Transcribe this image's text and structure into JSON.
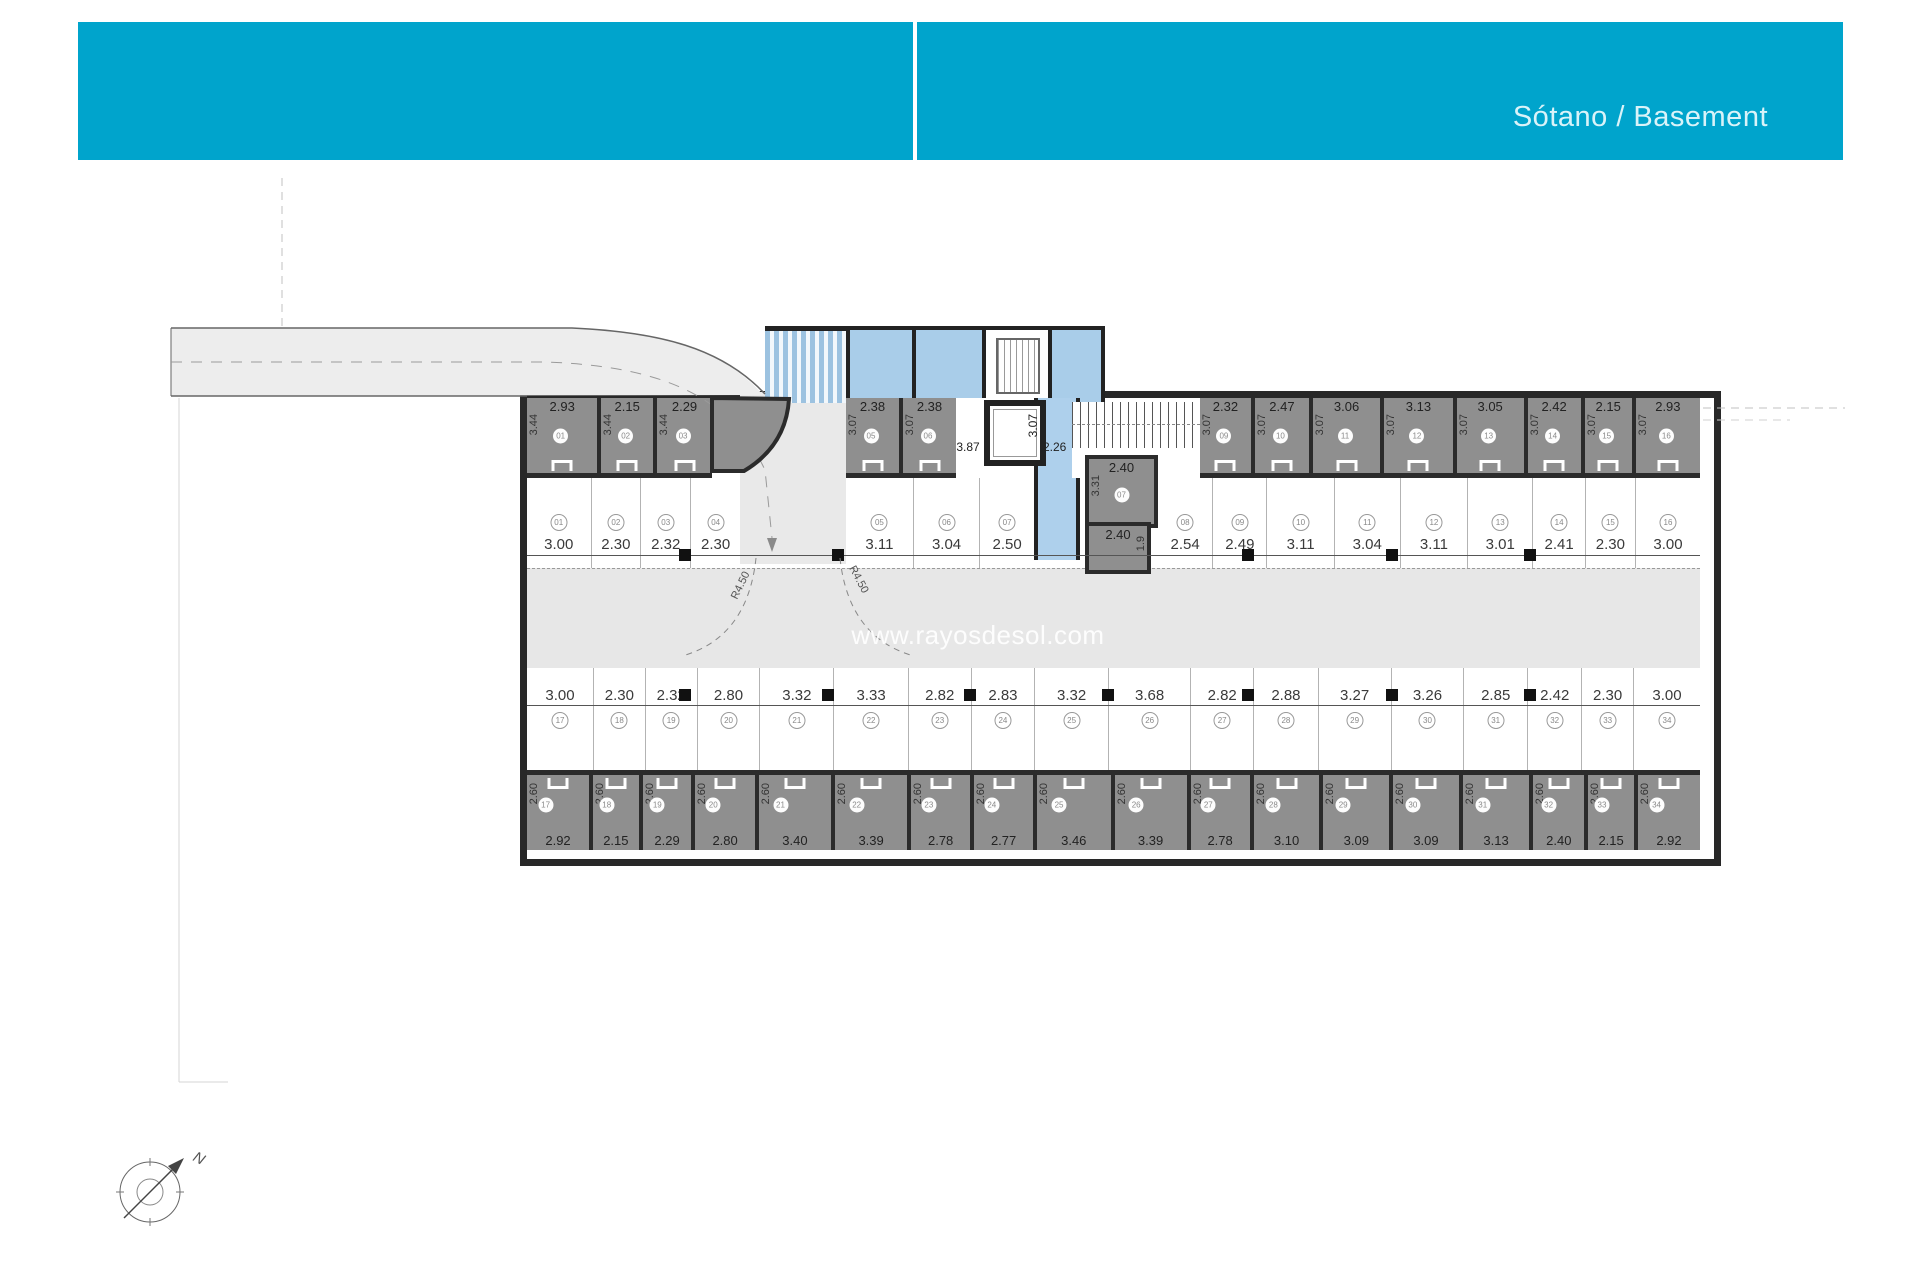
{
  "header": {
    "title": "Sótano / Basement",
    "accent_color": "#00a4cc"
  },
  "watermark": "www.rayosdesol.com",
  "compass_label": "N",
  "ramp_labels": {
    "r1": "R4.50",
    "r2": "R4.50"
  },
  "core": {
    "lobby_width": "3.87",
    "corridor_width": "2.26",
    "corridor_depth": "3.07",
    "box1": {
      "no": "07",
      "w": "2.40",
      "d": "3.31"
    },
    "box2": {
      "w": "2.40",
      "d": "1.9"
    }
  },
  "curved_unit": {
    "no": "04",
    "w": "2.80",
    "d": "3.44"
  },
  "rows": {
    "storage_top_left": {
      "units": [
        {
          "no": "01",
          "w": "2.93",
          "d": "3.44"
        },
        {
          "no": "02",
          "w": "2.15",
          "d": "3.44"
        },
        {
          "no": "03",
          "w": "2.29",
          "d": "3.44"
        }
      ]
    },
    "storage_top_mid": {
      "units": [
        {
          "no": "05",
          "w": "2.38",
          "d": "3.07"
        },
        {
          "no": "06",
          "w": "2.38",
          "d": "3.07"
        }
      ]
    },
    "storage_top_right": {
      "units": [
        {
          "no": "09",
          "w": "2.32",
          "d": "3.07"
        },
        {
          "no": "10",
          "w": "2.47",
          "d": "3.07"
        },
        {
          "no": "11",
          "w": "3.06",
          "d": "3.07"
        },
        {
          "no": "12",
          "w": "3.13",
          "d": "3.07"
        },
        {
          "no": "13",
          "w": "3.05",
          "d": "3.07"
        },
        {
          "no": "14",
          "w": "2.42",
          "d": "3.07"
        },
        {
          "no": "15",
          "w": "2.15",
          "d": "3.07"
        },
        {
          "no": "16",
          "w": "2.93",
          "d": "3.07"
        }
      ]
    },
    "parking_upper_left": {
      "units": [
        {
          "no": "01",
          "w": "3.00"
        },
        {
          "no": "02",
          "w": "2.30"
        },
        {
          "no": "03",
          "w": "2.32"
        },
        {
          "no": "04",
          "w": "2.30"
        }
      ]
    },
    "parking_upper_mid": {
      "units": [
        {
          "no": "05",
          "w": "3.11"
        },
        {
          "no": "06",
          "w": "3.04"
        },
        {
          "no": "07",
          "w": "2.50"
        }
      ]
    },
    "parking_upper_right": {
      "units": [
        {
          "no": "08",
          "w": "2.54"
        },
        {
          "no": "09",
          "w": "2.49"
        },
        {
          "no": "10",
          "w": "3.11"
        },
        {
          "no": "11",
          "w": "3.04"
        },
        {
          "no": "12",
          "w": "3.11"
        },
        {
          "no": "13",
          "w": "3.01"
        },
        {
          "no": "14",
          "w": "2.41"
        },
        {
          "no": "15",
          "w": "2.30"
        },
        {
          "no": "16",
          "w": "3.00"
        }
      ]
    },
    "parking_lower": {
      "units": [
        {
          "no": "17",
          "w": "3.00"
        },
        {
          "no": "18",
          "w": "2.30"
        },
        {
          "no": "19",
          "w": "2.32"
        },
        {
          "no": "20",
          "w": "2.80"
        },
        {
          "no": "21",
          "w": "3.32"
        },
        {
          "no": "22",
          "w": "3.33"
        },
        {
          "no": "23",
          "w": "2.82"
        },
        {
          "no": "24",
          "w": "2.83"
        },
        {
          "no": "25",
          "w": "3.32"
        },
        {
          "no": "26",
          "w": "3.68"
        },
        {
          "no": "27",
          "w": "2.82"
        },
        {
          "no": "28",
          "w": "2.88"
        },
        {
          "no": "29",
          "w": "3.27"
        },
        {
          "no": "30",
          "w": "3.26"
        },
        {
          "no": "31",
          "w": "2.85"
        },
        {
          "no": "32",
          "w": "2.42"
        },
        {
          "no": "33",
          "w": "2.30"
        },
        {
          "no": "34",
          "w": "3.00"
        }
      ]
    },
    "storage_bottom": {
      "units": [
        {
          "no": "17",
          "w": "2.92",
          "d": "2.60"
        },
        {
          "no": "18",
          "w": "2.15",
          "d": "2.60"
        },
        {
          "no": "19",
          "w": "2.29",
          "d": "2.60"
        },
        {
          "no": "20",
          "w": "2.80",
          "d": "2.60"
        },
        {
          "no": "21",
          "w": "3.40",
          "d": "2.60"
        },
        {
          "no": "22",
          "w": "3.39",
          "d": "2.60"
        },
        {
          "no": "23",
          "w": "2.78",
          "d": "2.60"
        },
        {
          "no": "24",
          "w": "2.77",
          "d": "2.60"
        },
        {
          "no": "25",
          "w": "3.46",
          "d": "2.60"
        },
        {
          "no": "26",
          "w": "3.39",
          "d": "2.60"
        },
        {
          "no": "27",
          "w": "2.78",
          "d": "2.60"
        },
        {
          "no": "28",
          "w": "3.10",
          "d": "2.60"
        },
        {
          "no": "29",
          "w": "3.09",
          "d": "2.60"
        },
        {
          "no": "30",
          "w": "3.09",
          "d": "2.60"
        },
        {
          "no": "31",
          "w": "3.13",
          "d": "2.60"
        },
        {
          "no": "32",
          "w": "2.40",
          "d": "2.60"
        },
        {
          "no": "33",
          "w": "2.15",
          "d": "2.60"
        },
        {
          "no": "34",
          "w": "2.92",
          "d": "2.60"
        }
      ]
    }
  }
}
